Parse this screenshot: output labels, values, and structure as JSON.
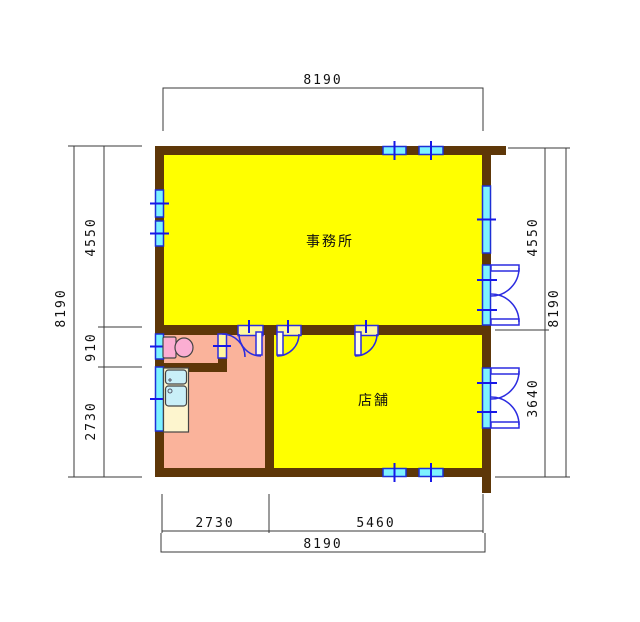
{
  "drawing": {
    "type": "floor-plan",
    "rooms": {
      "office": "事務所",
      "shop": "店舗"
    },
    "dims": {
      "top_total": "8190",
      "bottom_seg1": "2730",
      "bottom_seg2": "5460",
      "bottom_total": "8190",
      "left_seg1": "4550",
      "left_seg2": "910",
      "left_seg3": "2730",
      "left_total": "8190",
      "right_seg1": "4550",
      "right_seg2": "3640",
      "right_total": "8190"
    },
    "colors": {
      "room_fill": "#FFFF00",
      "hall_fill": "#FAB39B",
      "wall": "#5E3708",
      "window_fill": "#7DF2FF",
      "window_stroke": "#1C2FD6",
      "door_stroke": "#2C2CE0",
      "door_frame_fill": "#FFF7A0",
      "toilet_fill": "#FBAED2",
      "counter_fill": "#FDF5CE",
      "sink_fill": "#C9EFF8",
      "dim_line": "#3A3A3A",
      "text": "#111111"
    }
  }
}
